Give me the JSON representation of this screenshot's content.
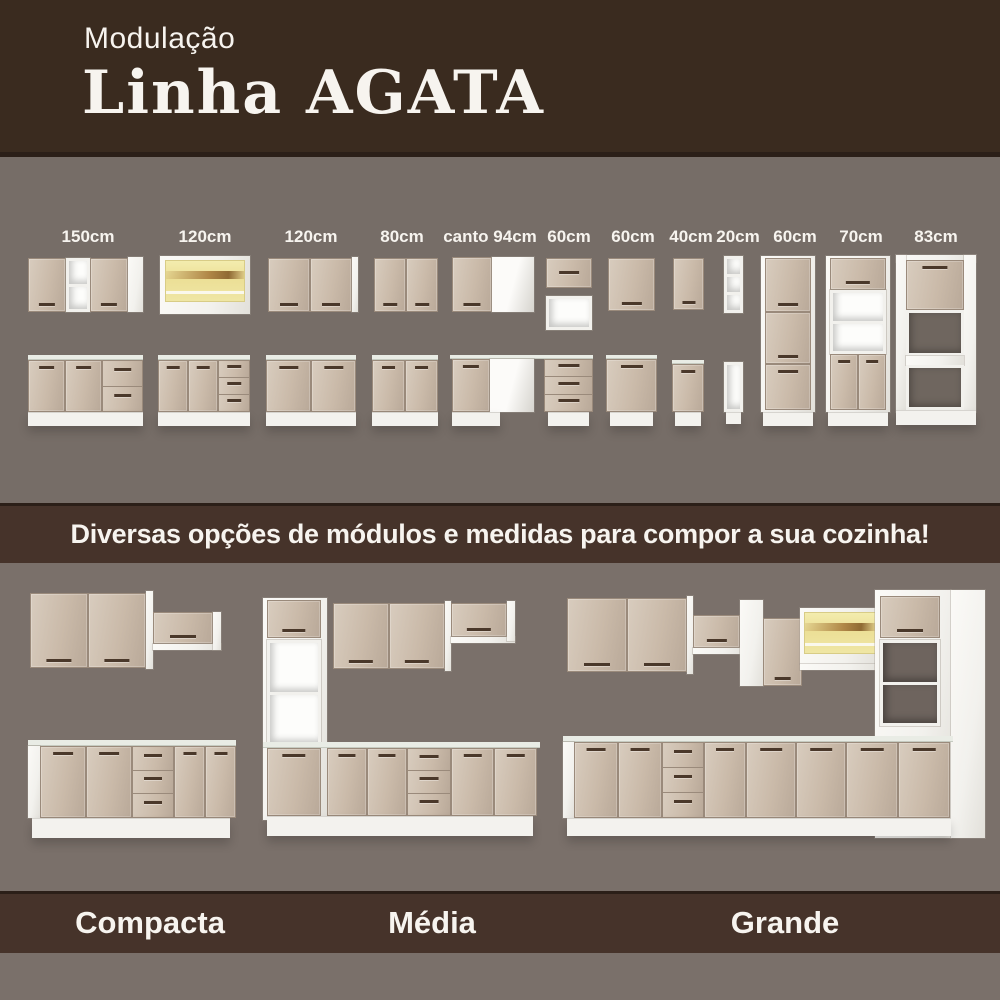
{
  "header": {
    "kicker": "Modulação",
    "title": "Linha AGATA"
  },
  "modules": {
    "labels": [
      "150cm",
      "120cm",
      "120cm",
      "80cm",
      "canto 94cm",
      "60cm",
      "60cm",
      "40cm",
      "20cm",
      "60cm",
      "70cm",
      "83cm"
    ]
  },
  "banner": {
    "text": "Diversas opções de módulos e medidas para compor a sua cozinha!"
  },
  "kitchens": {
    "items": [
      {
        "name": "Compacta"
      },
      {
        "name": "Média"
      },
      {
        "name": "Grande"
      }
    ]
  },
  "colors": {
    "header_brown": "#3a2b1f",
    "band_brown": "#46332a",
    "edge_brown": "#2b1f18",
    "upper_gray": "#766d67",
    "lower_gray": "#7a706a",
    "door_beige": "#cdbfb0",
    "door_beige_dark": "#b9a999",
    "cabinet_white": "#f2f1ed",
    "counter_white": "#e9ece5",
    "glass_yellow": "#ecdf96",
    "wood_brown": "#b08747",
    "handle_brown": "#4a382a",
    "text_white": "#f7f4ef"
  }
}
